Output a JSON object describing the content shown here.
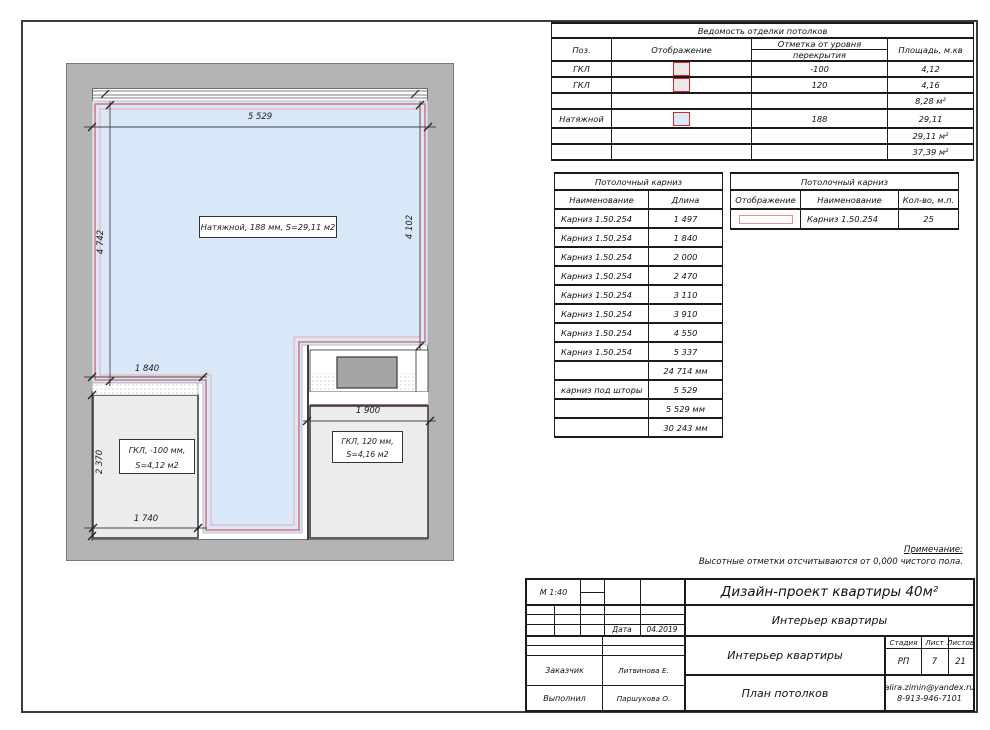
{
  "note": {
    "title": "Примечание:",
    "text": "Высотные отметки отсчитываются от 0,000 чистого пола."
  },
  "finish_table": {
    "title": "Ведомость отделки потолков",
    "headers": {
      "pos": "Поз.",
      "display": "Отображение",
      "level_line1": "Отметка от уровня",
      "level_line2": "перекрытия",
      "area": "Площадь, м.кв"
    },
    "rows": [
      {
        "pos": "ГКЛ",
        "swatch": "gray",
        "level": "-100",
        "area": "4,12"
      },
      {
        "pos": "ГКЛ",
        "swatch": "gray",
        "level": "120",
        "area": "4,16"
      },
      {
        "pos": "",
        "swatch": "",
        "level": "",
        "area": "8,28 м²"
      },
      {
        "pos": "Натяжной",
        "swatch": "blue",
        "level": "188",
        "area": "29,11"
      },
      {
        "pos": "",
        "swatch": "",
        "level": "",
        "area": "29,11 м²"
      },
      {
        "pos": "",
        "swatch": "",
        "level": "",
        "area": "37,39 м²"
      }
    ]
  },
  "cornice_table": {
    "title": "Потолочный карниз",
    "headers": {
      "name": "Наименование",
      "length": "Длина"
    },
    "rows": [
      {
        "name": "Карниз 1.50.254",
        "length": "1 497"
      },
      {
        "name": "Карниз 1.50.254",
        "length": "1 840"
      },
      {
        "name": "Карниз 1.50.254",
        "length": "2 000"
      },
      {
        "name": "Карниз 1.50.254",
        "length": "2 470"
      },
      {
        "name": "Карниз 1.50.254",
        "length": "3 110"
      },
      {
        "name": "Карниз 1.50.254",
        "length": "3 910"
      },
      {
        "name": "Карниз 1.50.254",
        "length": "4 550"
      },
      {
        "name": "Карниз 1.50.254",
        "length": "5 337"
      },
      {
        "name": "",
        "length": "24 714 мм"
      },
      {
        "name": "карниз под шторы",
        "length": "5 529"
      },
      {
        "name": "",
        "length": "5 529 мм"
      },
      {
        "name": "",
        "length": "30 243 мм"
      }
    ]
  },
  "cornice_summary": {
    "title": "Потолочный карниз",
    "headers": {
      "display": "Отображение",
      "name": "Наименование",
      "qty": "Кол-во, м.п."
    },
    "row": {
      "name": "Карниз 1.50.254",
      "qty": "25"
    }
  },
  "plan": {
    "dim_top": "5 529",
    "dim_left": "4 742",
    "dim_right": "4 102",
    "dim_mid": "1 840",
    "dim_bottom_left_v": "2 370",
    "dim_bottom_left_h": "1 740",
    "dim_bottom_right": "1 900",
    "label_stretch": "Натяжной,  188 мм,  S=29,11 м2",
    "label_gkl1_line1": "ГКЛ, -100 мм,",
    "label_gkl1_line2": "S=4,12 м2",
    "label_gkl2_line1": "ГКЛ, 120 мм,",
    "label_gkl2_line2": "S=4,16 м2"
  },
  "title_block": {
    "scale": "М 1:40",
    "date_label": "Дата",
    "date_value": "04.2019",
    "project_title": "Дизайн-проект квартиры 40м²",
    "subtitle": "Интерьер квартиры",
    "section_title": "Интерьер квартиры",
    "sheet_title": "План потолков",
    "stage_label": "Стадия",
    "sheet_label": "Лист",
    "sheets_label": "Листов",
    "stage_value": "РП",
    "sheet_value": "7",
    "sheets_value": "21",
    "client_label": "Заказчик",
    "client_value": "Литвинова Е.",
    "author_label": "Выполнил",
    "author_value": "Паршукова О.",
    "email": "alira.zimin@yandex.ru",
    "phone": "8-913-946-7101"
  },
  "colors": {
    "stretch_ceiling_fill": "#d9e8f9",
    "gkl_fill": "#ececec",
    "cornice_red": "#dd5a5a",
    "swatch_border_red": "#cf2b2b",
    "wall_gray": "#b4b4b4"
  }
}
